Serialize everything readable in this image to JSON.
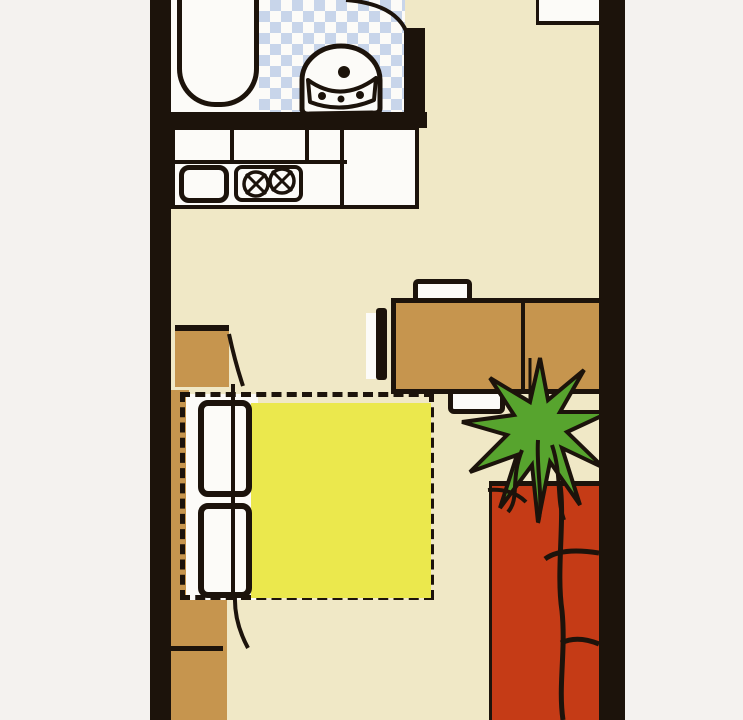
{
  "meta": {
    "type": "floor-plan",
    "style": "hand-drawn scanned illustration",
    "description": "Studio apartment floor plan: bathroom with bathtub and washbasin on blue checkered tiles, kitchen counter with sink and two-burner stove, entry cabinet, wardrobe, fold-out sofa-bed with dashed extension outline and yellow rug, wall shelf, dining table with three chairs, potted plant, red sofa along right wall",
    "visible_text": "none"
  },
  "colors": {
    "page": "#f4f2ef",
    "ink": "#1c130b",
    "floor": "#f0e8c6",
    "tile": "#c8d5ea",
    "fixture": "#fcfbf8",
    "wood": "#c6954e",
    "rug": "#ebe84d",
    "sofa": "#c53b16",
    "plant": "#57a42e"
  },
  "rooms": [
    {
      "name": "bathroom",
      "floor": "blue-white checkered tile"
    },
    {
      "name": "kitchen",
      "floor": "cream"
    },
    {
      "name": "entry",
      "floor": "cream"
    },
    {
      "name": "living-room",
      "floor": "cream"
    }
  ],
  "furniture": [
    {
      "name": "bathtub",
      "room": "bathroom"
    },
    {
      "name": "washbasin",
      "room": "bathroom"
    },
    {
      "name": "bathroom-door-swing",
      "room": "bathroom"
    },
    {
      "name": "kitchen-counter",
      "room": "kitchen"
    },
    {
      "name": "kitchen-sink",
      "room": "kitchen"
    },
    {
      "name": "stove-two-burners",
      "room": "kitchen"
    },
    {
      "name": "entry-cabinet",
      "room": "entry"
    },
    {
      "name": "wardrobe",
      "room": "living-room"
    },
    {
      "name": "wall-shelf",
      "room": "living-room"
    },
    {
      "name": "low-cabinet",
      "room": "living-room"
    },
    {
      "name": "sofa-bed-cushions",
      "room": "living-room"
    },
    {
      "name": "fold-out-bed-outline",
      "room": "living-room",
      "style": "dashed"
    },
    {
      "name": "yellow-rug",
      "room": "living-room"
    },
    {
      "name": "dining-table",
      "room": "living-room"
    },
    {
      "name": "chair-top",
      "room": "living-room"
    },
    {
      "name": "chair-left",
      "room": "living-room"
    },
    {
      "name": "chair-bottom",
      "room": "living-room"
    },
    {
      "name": "potted-plant",
      "room": "living-room"
    },
    {
      "name": "red-sofa",
      "room": "living-room"
    }
  ]
}
